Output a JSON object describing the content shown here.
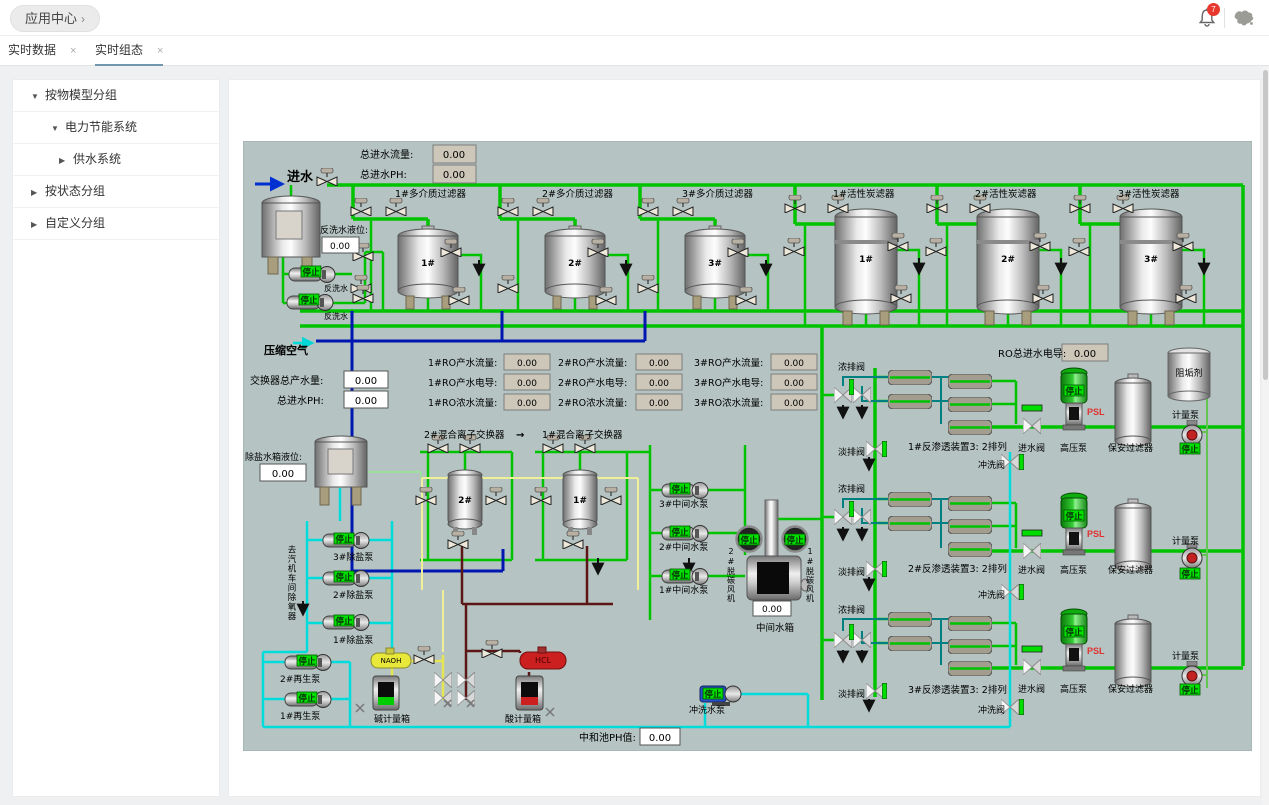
{
  "header": {
    "app_center_label": "应用中心",
    "app_center_chevron": "›",
    "bell_badge": "7"
  },
  "tabs": {
    "tab1": "实时数据",
    "tab2": "实时组态",
    "close": "×"
  },
  "sidebar": {
    "arrow_down": "▼",
    "arrow_right": "▶",
    "items": [
      {
        "label": "按物模型分组"
      },
      {
        "label": "电力节能系统"
      },
      {
        "label": "供水系统"
      },
      {
        "label": "按状态分组"
      },
      {
        "label": "自定义分组"
      }
    ]
  },
  "scada": {
    "labels": {
      "inflow": "进水",
      "total_flow": "总进水流量:",
      "total_ph": "总进水PH:",
      "backwash_level": "反洗水液位:",
      "backwash_water": "反洗水",
      "mm1": "1#多介质过滤器",
      "mm2": "2#多介质过滤器",
      "mm3": "3#多介质过滤器",
      "ac1": "1#活性炭滤器",
      "ac2": "2#活性炭滤器",
      "ac3": "3#活性炭滤器",
      "no1": "1#",
      "no2": "2#",
      "no3": "3#",
      "compressed_air": "压缩空气",
      "exch_total": "交换器总产水量:",
      "inlet_ph": "总进水PH:",
      "ro1_flow": "1#RO产水流量:",
      "ro1_cond": "1#RO产水电导:",
      "ro1_conc": "1#RO浓水流量:",
      "ro2_flow": "2#RO产水流量:",
      "ro2_cond": "2#RO产水电导:",
      "ro2_conc": "2#RO浓水流量:",
      "ro3_flow": "3#RO产水流量:",
      "ro3_cond": "3#RO产水电导:",
      "ro3_conc": "3#RO浓水流量:",
      "ro_total_cond": "RO总进水电导:",
      "mix2": "2#混合离子交换器",
      "mix1": "1#混合离子交换器",
      "arrow_right": "→",
      "desalt_level": "除盐水箱液位:",
      "to_deaerator": "去汽机车间除氧器",
      "dp3": "3#除盐泵",
      "dp2": "2#除盐泵",
      "dp1": "1#除盐泵",
      "rp2": "2#再生泵",
      "rp1": "1#再生泵",
      "naoh": "NAOH",
      "alkali": "碱计量箱",
      "hcl": "HCL",
      "acid": "酸计量箱",
      "mp3": "3#中间水泵",
      "mp2": "2#中间水泵",
      "mp1": "1#中间水泵",
      "fan2": "2#脱碳风机",
      "fan1": "1#脱碳风机",
      "mid_tank": "中间水箱",
      "flush_pump": "冲洗水泵",
      "neutral_ph": "中和池PH值:",
      "conc_v": "浓排阀",
      "perm_v": "淡排阀",
      "inlet_v": "进水阀",
      "flush_v": "冲洗阀",
      "hp_pump": "高压泵",
      "sec_filter": "保安过滤器",
      "meter_pump": "计量泵",
      "antiscalant": "阻垢剂",
      "ro_unit1": "1#反渗透装置3: 2排列",
      "ro_unit2": "2#反渗透装置3: 2排列",
      "ro_unit3": "3#反渗透装置3: 2排列",
      "stop": "停止",
      "psl": "PSL"
    },
    "values": {
      "total_flow": "0.00",
      "total_ph": "0.00",
      "backwash_level": "0.00",
      "exch_total": "0.00",
      "inlet_ph": "0.00",
      "ro1_flow": "0.00",
      "ro1_cond": "0.00",
      "ro1_conc": "0.00",
      "ro2_flow": "0.00",
      "ro2_cond": "0.00",
      "ro2_conc": "0.00",
      "ro3_flow": "0.00",
      "ro3_cond": "0.00",
      "ro3_conc": "0.00",
      "ro_total_cond": "0.00",
      "desalt_level": "0.00",
      "mid_tank_level": "0.00",
      "neutral_ph": "0.00"
    }
  }
}
